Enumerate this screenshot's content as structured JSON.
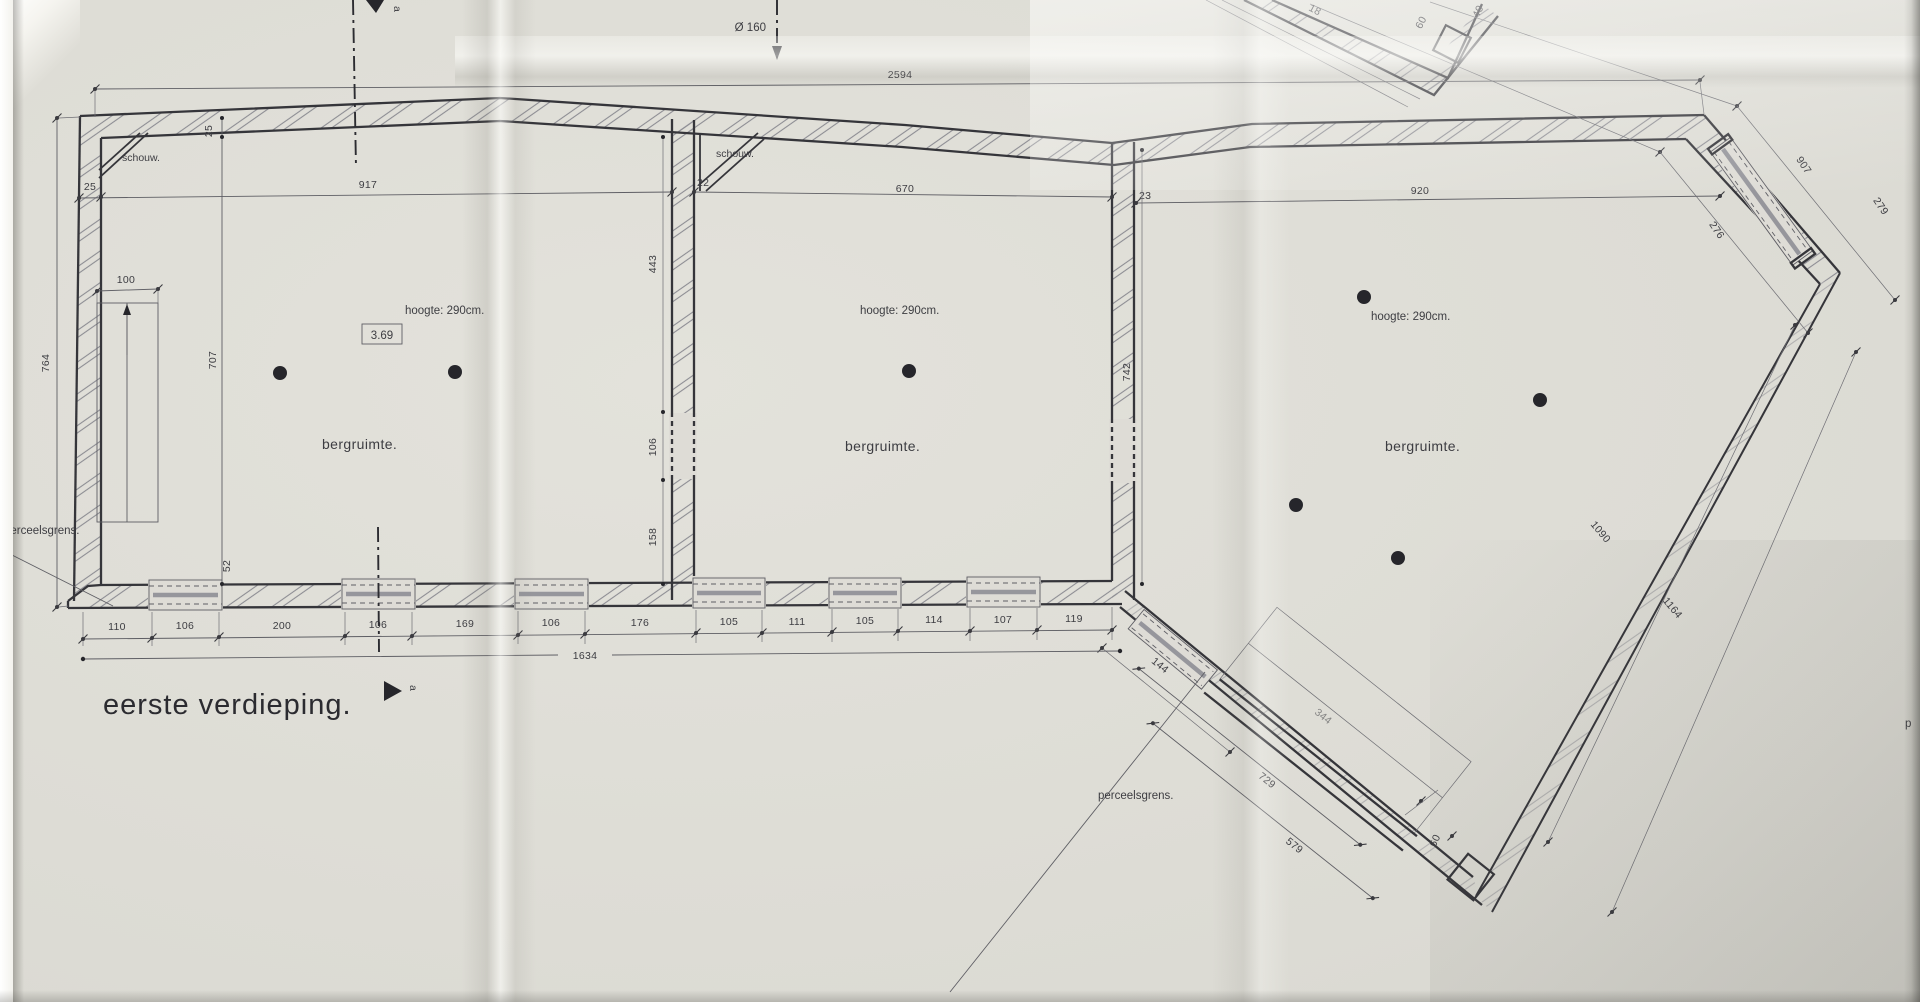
{
  "drawing": {
    "title": "eerste verdieping.",
    "section_marker": "a",
    "duct_note": "Ø 160",
    "level_box": "3.69",
    "parcel_boundary_label": "perceelsgrens.",
    "parcel_boundary_label_right": "p",
    "rooms": [
      {
        "name": "bergruimte.",
        "height_note": "hoogte: 290cm."
      },
      {
        "name": "bergruimte.",
        "height_note": "hoogte: 290cm."
      },
      {
        "name": "bergruimte.",
        "height_note": "hoogte: 290cm."
      }
    ],
    "chimney_labels": [
      "schouw.",
      "schouw."
    ],
    "dims": {
      "overall_top": "2594",
      "overall_bottom": "1634",
      "room1_width": "917",
      "room2_width": "670",
      "room3_width": "920",
      "left_height": "764",
      "room1_depth": "707",
      "top_wall_thickness": "25",
      "left_wall_thickness": "25",
      "divider12_thickness": "22",
      "divider23_thickness": "23",
      "divider12_upper": "443",
      "divider12_opening": "106",
      "divider12_lower": "158",
      "divider23_depth": "742",
      "bottom_wall_thickness": "52",
      "stair_width": "100",
      "chamfer_window": "276",
      "chamfer_length": "907",
      "chamfer_outer": "279",
      "east_inner": "1090",
      "east_outer": "1164",
      "diag_window": "144",
      "stair_run_inner": "729",
      "stair_run_outer": "579",
      "stair_note": "344",
      "corner_dim": "60",
      "fragment_dims": [
        "18",
        "60",
        "40"
      ],
      "bottom_chain": [
        "110",
        "106",
        "200",
        "106",
        "169",
        "106",
        "176",
        "105",
        "111",
        "105",
        "114",
        "107",
        "119"
      ]
    }
  }
}
